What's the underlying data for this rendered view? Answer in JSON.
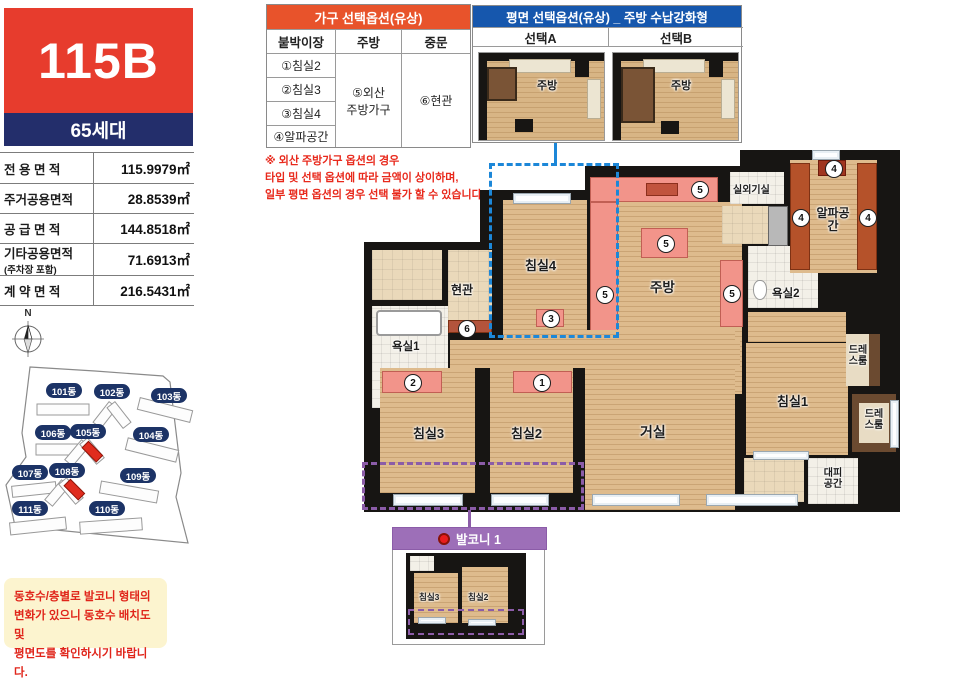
{
  "unit": {
    "code": "115B",
    "households": "65세대"
  },
  "area_table": {
    "rows": [
      {
        "label": "전 용 면 적",
        "note": "",
        "value": "115.9979㎡"
      },
      {
        "label": "주거공용면적",
        "note": "",
        "value": "28.8539㎡"
      },
      {
        "label": "공 급 면 적",
        "note": "",
        "value": "144.8518㎡"
      },
      {
        "label": "기타공용면적",
        "note": "(주차장 포함)",
        "value": "71.6913㎡"
      },
      {
        "label": "계 약 면 적",
        "note": "",
        "value": "216.5431㎡"
      }
    ]
  },
  "furniture_options": {
    "title": "가구 선택옵션(유상)",
    "col1": "붙박이장",
    "col2": "주방",
    "col3": "중문",
    "items1": [
      "①침실2",
      "②침실3",
      "③침실4",
      "④알파공간"
    ],
    "item2_line1": "⑤외산",
    "item2_line2": "주방가구",
    "item3": "⑥현관"
  },
  "plan_options": {
    "title": "평면 선택옵션(유상) _ 주방 수납강화형",
    "choice_a": "선택A",
    "choice_b": "선택B",
    "kitchen": "주방"
  },
  "kitchen_note": {
    "line1": "※ 외산 주방가구 옵션의 경우",
    "line2": "타입 및 선택 옵션에 따라 금액이 상이하며,",
    "line3": "일부 평면 옵션의 경우 선택 불가 할 수 있습니다."
  },
  "compass": {
    "label": "N"
  },
  "site_map": {
    "buildings": [
      "101동",
      "102동",
      "103동",
      "106동",
      "105동",
      "104동",
      "107동",
      "108동",
      "109동",
      "111동",
      "110동"
    ]
  },
  "notice": {
    "line1": "동호수/층별로 발코니 형태의",
    "line2": "변화가 있으니 동호수 배치도 및",
    "line3": "평면도를 확인하시기 바랍니다."
  },
  "plan": {
    "rooms": {
      "entrance": "현관",
      "bath1": "욕실1",
      "bed4": "침실4",
      "kitchen": "주방",
      "outdoor": "실외기실",
      "alpha": "알파공간",
      "bath2": "욕실2",
      "dress1": "드레스룸",
      "bed1": "침실1",
      "dress2": "드레스룸",
      "evac": "대피공간",
      "living": "거실",
      "bed2": "침실2",
      "bed3": "침실3"
    },
    "markers": {
      "m1": "1",
      "m2": "2",
      "m3": "3",
      "m4": "4",
      "m5": "5",
      "m6": "6"
    }
  },
  "balcony": {
    "title": "발코니 1",
    "bed3": "침실3",
    "bed2": "침실2"
  },
  "colors": {
    "unit_red": "#e73c2d",
    "unit_navy": "#232e6b",
    "option_orange": "#e8532b",
    "option_blue": "#1657ad",
    "balcony_purple": "#9d6fb8",
    "dash_blue": "#1c87d8",
    "dash_purple": "#8b5ca8",
    "note_red": "#e8291c",
    "pill_navy": "#1c3366"
  }
}
